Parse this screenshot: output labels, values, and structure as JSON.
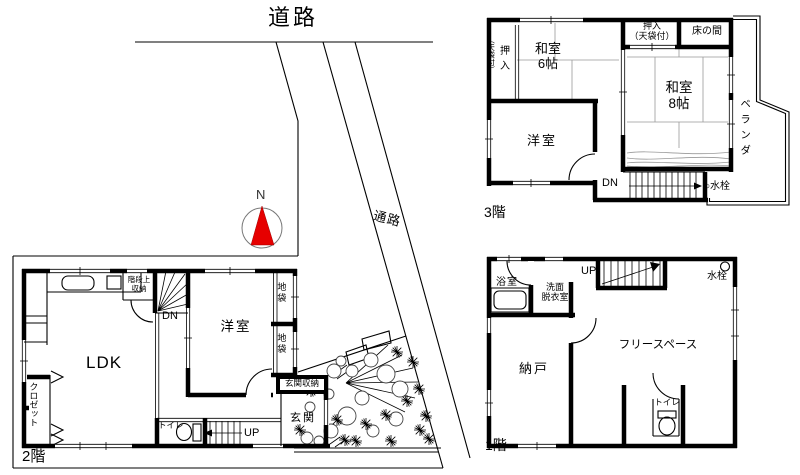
{
  "site": {
    "road_label": "道路",
    "passage_label": "通路",
    "compass_n": "N"
  },
  "floor3": {
    "label": "3階",
    "washitsu6": "和室\n6帖",
    "oshiire_side": "押入",
    "oshiire_side_note": "（天袋付）",
    "oshiire_top": "押入\n（天袋付）",
    "tokonoma": "床の間",
    "washitsu8": "和室\n8帖",
    "youshitsu": "洋室",
    "stairs_dn": "DN",
    "faucet": "○水栓",
    "veranda": "ベランダ"
  },
  "floor2": {
    "label": "2階",
    "ldk": "LDK",
    "youshitsu": "洋室",
    "stair_storage": "階段上\n収納",
    "stairs_dn": "DN",
    "jibukuro_upper": "地袋",
    "jibukuro_lower": "地袋",
    "genkan_storage": "玄関収納",
    "genkan": "玄関",
    "closet": "クロゼット",
    "toilet": "トイレ",
    "stairs_up": "UP"
  },
  "floor1": {
    "label": "1階",
    "bathroom": "浴室",
    "washroom": "洗面\n脱衣室",
    "stairs_up": "UP",
    "faucet": "水栓",
    "storage": "納戸",
    "free_space": "フリースペース",
    "toilet": "トイレ"
  },
  "colors": {
    "compass_needle": "#e60000",
    "wall": "#000000",
    "background": "#ffffff"
  }
}
